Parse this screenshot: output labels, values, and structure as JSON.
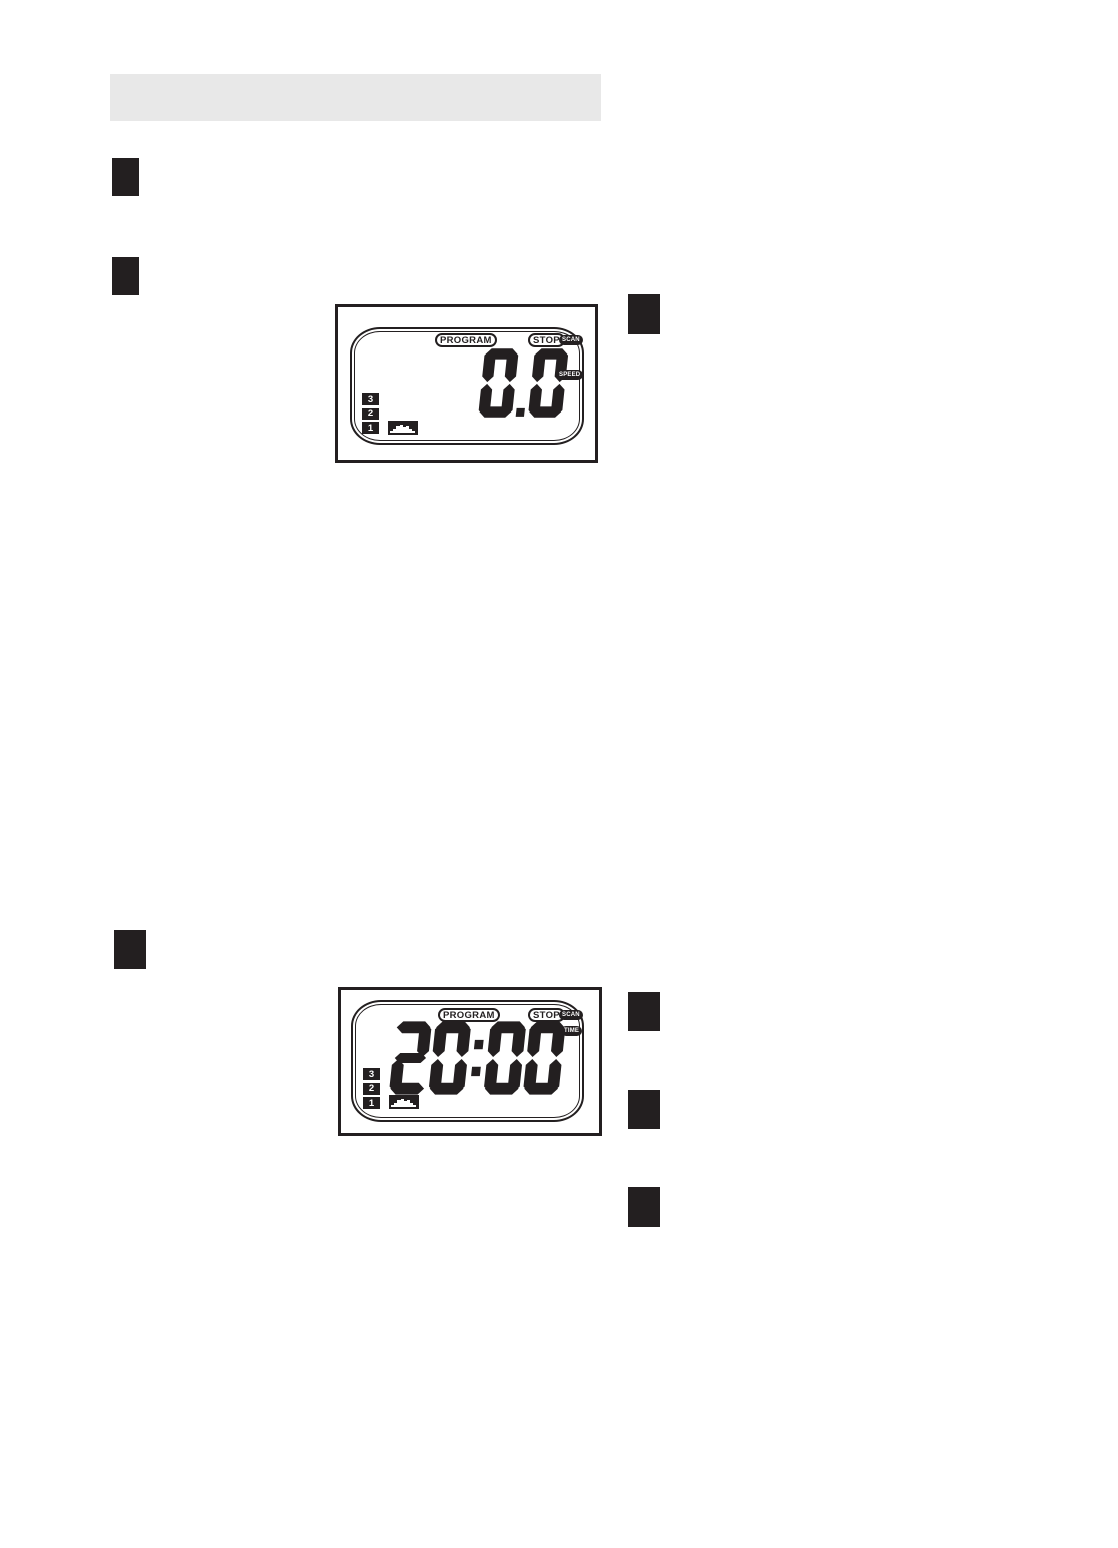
{
  "page": {
    "background": "#ffffff",
    "ink_color": "#231f20",
    "header_bar_color": "#e8e8e8"
  },
  "displays": [
    {
      "name": "speed-display",
      "program_label": "PROGRAM",
      "stop_label": "STOP",
      "scan_label": "SCAN",
      "unit_label": "SPEED",
      "readout_value": "0.0",
      "level_labels": [
        "3",
        "2",
        "1"
      ]
    },
    {
      "name": "time-display",
      "program_label": "PROGRAM",
      "stop_label": "STOP",
      "scan_label": "SCAN",
      "unit_label": "TIME",
      "readout_value": "20:00",
      "level_labels": [
        "3",
        "2",
        "1"
      ]
    }
  ]
}
